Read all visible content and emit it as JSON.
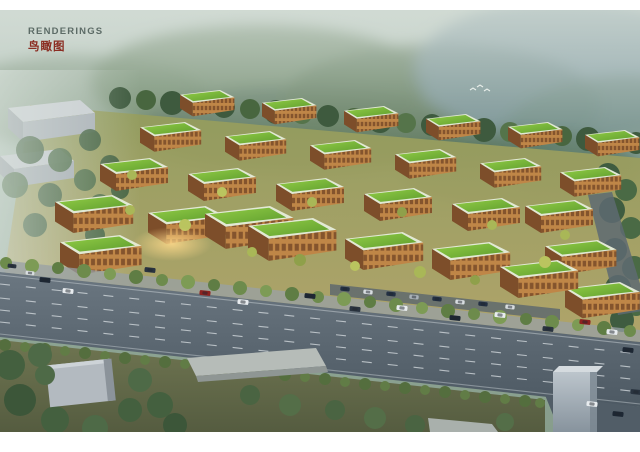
{
  "header": {
    "title_en": "RENDERINGS",
    "title_zh": "鸟瞰图"
  },
  "palette": {
    "title_en_color": "#5c6b66",
    "title_zh_color": "#8b2d22",
    "sky_haze": "#c6d2cb",
    "mountain_green": "#64805f",
    "mountain_blue": "#74909c",
    "roof_green": "#79b43a",
    "roof_parapet": "#e2e9d5",
    "facade_orange": "#bf8647",
    "tree_dark": "#41603f",
    "tree_accent": "#a9b757",
    "road_gray": "#5d6973",
    "lane_marking": "#d8dee2",
    "warehouse_gray": "#b3bac0",
    "frame_white": "#ffffff"
  }
}
